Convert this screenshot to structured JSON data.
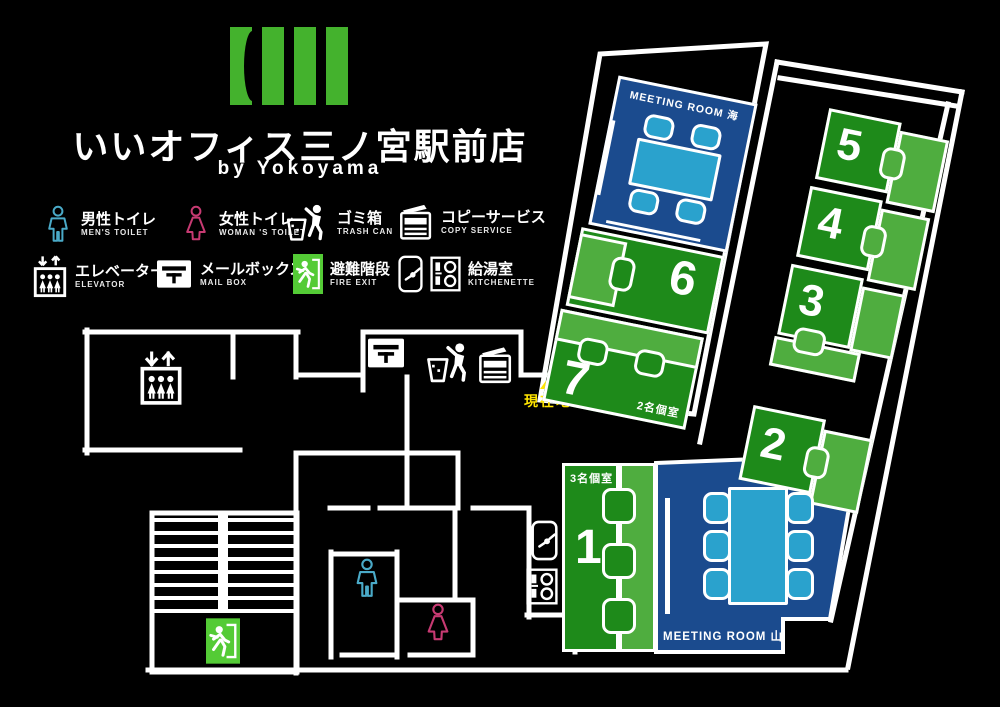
{
  "header": {
    "title": "いいオフィス三ノ宮駅前店",
    "subtitle": "by Yokoyama"
  },
  "legend": {
    "items": [
      {
        "icon": "mens-toilet-icon",
        "jp": "男性トイレ",
        "en": "MEN'S TOILET"
      },
      {
        "icon": "womens-toilet-icon",
        "jp": "女性トイレ",
        "en": "WOMAN 'S TOILET"
      },
      {
        "icon": "trash-can-icon",
        "jp": "ゴミ箱",
        "en": "TRASH CAN"
      },
      {
        "icon": "copier-icon",
        "jp": "コピーサービス",
        "en": "COPY SERVICE"
      },
      {
        "icon": "elevator-icon",
        "jp": "エレベーター",
        "en": "ELEVATOR"
      },
      {
        "icon": "mailbox-icon",
        "jp": "メールボックス",
        "en": "MAIL BOX"
      },
      {
        "icon": "fire-exit-icon",
        "jp": "避難階段",
        "en": "FIRE EXIT"
      },
      {
        "icon": "kitchenette-icon",
        "jp": "給湯室",
        "en": "KITCHENETTE"
      }
    ]
  },
  "floorplan": {
    "current_location_label": "現在地",
    "rooms": {
      "meeting_umi": {
        "label": "MEETING ROOM 海"
      },
      "room6": {
        "label": "6"
      },
      "room7": {
        "label": "7",
        "sublabel": "2名個室"
      },
      "room5": {
        "label": "5"
      },
      "room4": {
        "label": "4"
      },
      "room3": {
        "label": "3"
      },
      "room2": {
        "label": "2"
      },
      "room1": {
        "label": "1",
        "sublabel": "3名個室"
      },
      "meeting_yama": {
        "label": "MEETING ROOM 山"
      }
    },
    "colors": {
      "room_green": "#1e8a1a",
      "desk_green": "#4fad3f",
      "room_blue": "#1b4b8e",
      "table_blue": "#2aa2cd",
      "brand_green": "#44b22d",
      "fire_exit_green": "#54cb36",
      "marker_yellow": "#ffe400",
      "mens_blue": "#4aaac8",
      "womens_pink": "#c73a72",
      "wall_white": "#ffffff"
    }
  }
}
